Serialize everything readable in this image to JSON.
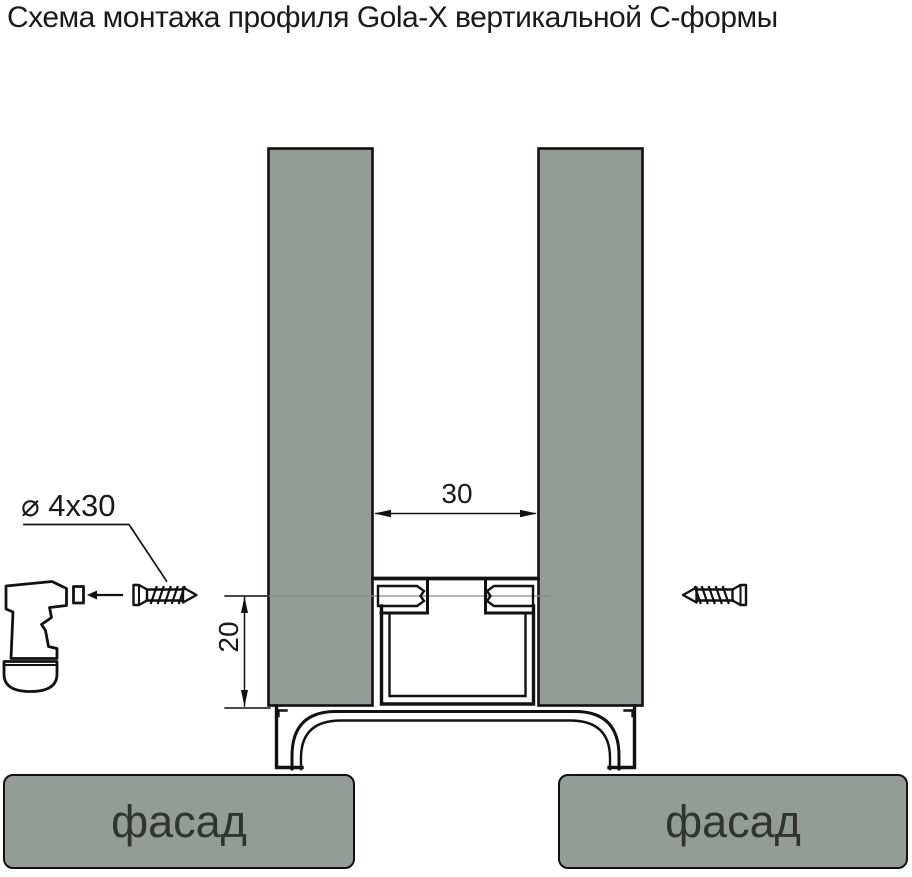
{
  "title": "Схема монтажа профиля Gola-X вертикальной С-формы",
  "diagram": {
    "annotations": {
      "screw_spec": "⌀ 4x30",
      "dim_gap_width": "30",
      "dim_offset_height": "20"
    },
    "facades": {
      "left_label": "фасад",
      "right_label": "фасад"
    },
    "icons": {
      "drill": "drill-icon",
      "screw_left": "screw-icon",
      "screw_right": "screw-icon",
      "profile": "gola-x-c-profile-cross-section"
    }
  },
  "colors": {
    "panel_fill": "#939C96",
    "outline": "#111111",
    "centerline": "#8A8A8A",
    "text": "#1A1A1A"
  }
}
